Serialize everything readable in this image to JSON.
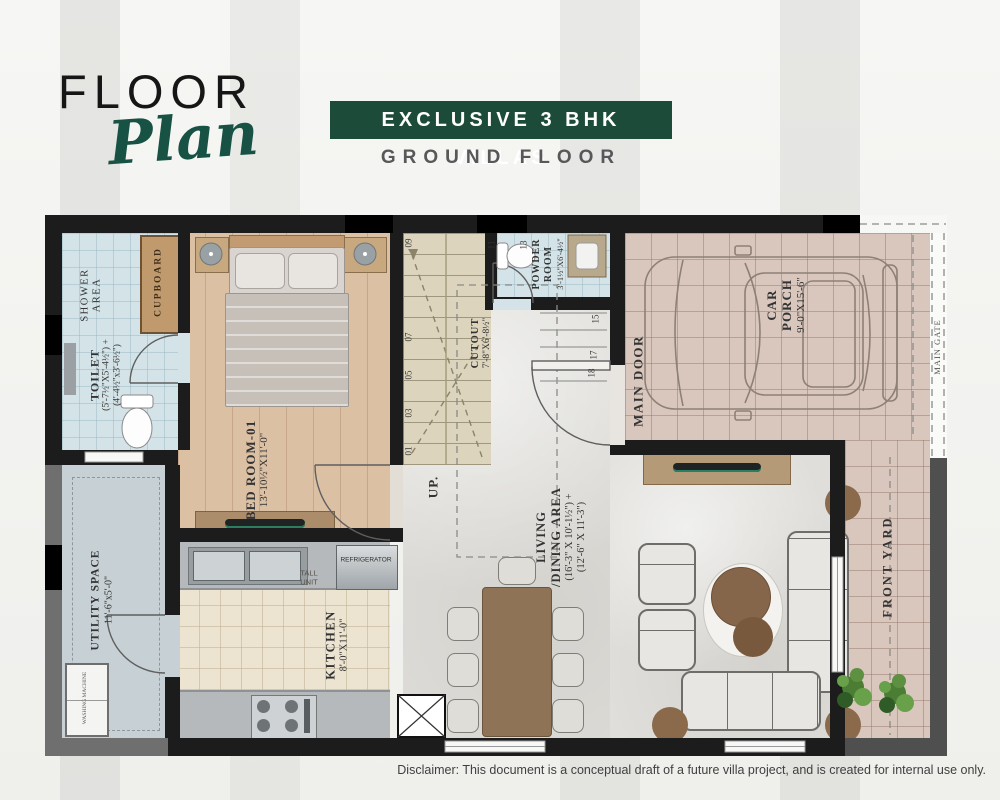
{
  "header": {
    "title_top": "FLOOR",
    "title_script": "Plan",
    "banner": "EXCLUSIVE 3 BHK VILLAS",
    "subtitle": "GROUND FLOOR"
  },
  "plan": {
    "shower": {
      "l1": "SHOWER",
      "l2": "AREA"
    },
    "cupboard": {
      "label": "CUPBOARD"
    },
    "toilet": {
      "name": "TOILET",
      "dim1": "(5'-7½\"X5'-4½\") +",
      "dim2": "(4'-4½\"x3'-6½\")"
    },
    "bedroom": {
      "name": "BED ROOM-01",
      "dim": "13'-10½\"X11'-0\""
    },
    "stairs": {
      "up": "UP.",
      "steps": [
        "01",
        "03",
        "05",
        "07",
        "09",
        "11",
        "13",
        "15",
        "17",
        "18"
      ]
    },
    "cutout": {
      "name": "CUTOUT",
      "dim": "7'-8\"X6'-8½\""
    },
    "powder": {
      "l1": "POWDER",
      "l2": "ROOM",
      "dim": "3'-1½\"X6'-4½\""
    },
    "main_door": {
      "label": "MAIN DOOR"
    },
    "car_porch": {
      "l1": "CAR",
      "l2": "PORCH",
      "dim": "9'-0\"X15'-6\""
    },
    "main_gate": {
      "label": "MAIN GATE"
    },
    "living": {
      "l1": "LIVING",
      "l2": "/DINING AREA",
      "dim1": "(16'-3\" X 10'-1½\") +",
      "dim2": "(12'-6\" X 11'-3\")"
    },
    "kitchen": {
      "name": "KITCHEN",
      "dim": "8'-0\"X11'-0\""
    },
    "tall_unit": {
      "l1": "TALL",
      "l2": "UNIT"
    },
    "refrigerator": {
      "label": "REFRIGERATOR"
    },
    "utility": {
      "name": "UTILITY SPACE",
      "dim": "11'-6\"x5'-0\""
    },
    "washing_machine": {
      "label": "WASHING MACHINE"
    },
    "front_yard": {
      "label": "FRONT YARD"
    }
  },
  "footer": {
    "disclaimer": "Disclaimer: This document is a conceptual draft of a future villa project, and is created for internal use only."
  },
  "colors": {
    "banner_green": "#1d4b3a",
    "script_green": "#175244",
    "wall_black": "#1c1c1c",
    "wood_floor": "#dcc0a4",
    "bath_blue": "#d4e3e7",
    "porch_tile": "#d9c7be"
  }
}
